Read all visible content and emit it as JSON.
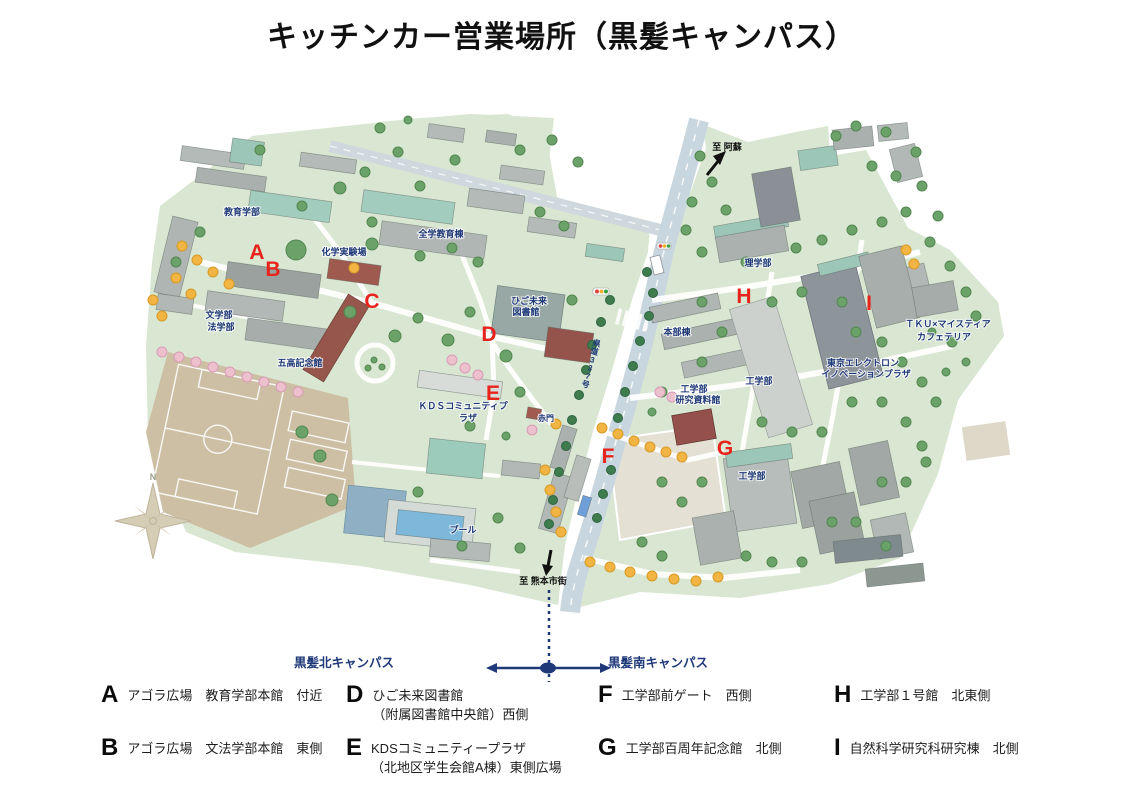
{
  "title": "キッチンカー営業場所（黒髪キャンパス）",
  "colors": {
    "marker_red": "#e8231c",
    "label_navy": "#1e3878",
    "campus_green": "#d9e7d2",
    "road_blue": "#c7d6df",
    "field_tan": "#cdbfa4"
  },
  "map": {
    "markers": [
      {
        "id": "A",
        "x": 257,
        "y": 259
      },
      {
        "id": "B",
        "x": 273,
        "y": 276
      },
      {
        "id": "C",
        "x": 372,
        "y": 308
      },
      {
        "id": "D",
        "x": 489,
        "y": 341
      },
      {
        "id": "E",
        "x": 493,
        "y": 400
      },
      {
        "id": "F",
        "x": 608,
        "y": 463
      },
      {
        "id": "G",
        "x": 725,
        "y": 455
      },
      {
        "id": "H",
        "x": 744,
        "y": 303
      },
      {
        "id": "I",
        "x": 869,
        "y": 310
      }
    ],
    "labels": [
      {
        "text": "教育学部",
        "x": 242,
        "y": 215
      },
      {
        "text": "化学実験場",
        "x": 344,
        "y": 255
      },
      {
        "text": "全学教育棟",
        "x": 441,
        "y": 237
      },
      {
        "text": "文学部",
        "x": 219,
        "y": 318
      },
      {
        "text": "法学部",
        "x": 221,
        "y": 330
      },
      {
        "text": "五高記念館",
        "x": 300,
        "y": 366
      },
      {
        "text": "ひご未来",
        "x": 529,
        "y": 304
      },
      {
        "text": "図書館",
        "x": 526,
        "y": 315
      },
      {
        "text": "ＫＤＳコミュニティプ",
        "x": 463,
        "y": 409
      },
      {
        "text": "ラザ",
        "x": 468,
        "y": 421
      },
      {
        "text": "赤門",
        "x": 546,
        "y": 421,
        "size": 8
      },
      {
        "text": "プール",
        "x": 463,
        "y": 533
      },
      {
        "text": "本部棟",
        "x": 677,
        "y": 335
      },
      {
        "text": "理学部",
        "x": 758,
        "y": 266
      },
      {
        "text": "工学部",
        "x": 694,
        "y": 392
      },
      {
        "text": "研究資料館",
        "x": 698,
        "y": 403
      },
      {
        "text": "工学部",
        "x": 759,
        "y": 384
      },
      {
        "text": "東京エレクトロン",
        "x": 863,
        "y": 366
      },
      {
        "text": "イノベーションプラザ",
        "x": 866,
        "y": 377
      },
      {
        "text": "ＴＫＵ×マイスティア",
        "x": 948,
        "y": 327
      },
      {
        "text": "カフェテリア",
        "x": 944,
        "y": 340
      },
      {
        "text": "工学部",
        "x": 752,
        "y": 479
      }
    ],
    "road_label": {
      "text": "県道337号",
      "x": 596,
      "y": 346,
      "rotate": 15
    },
    "direction_labels": [
      {
        "text": "至 阿蘇",
        "x": 727,
        "y": 150
      },
      {
        "text": "至 熊本市街",
        "x": 543,
        "y": 584
      }
    ],
    "compass_label": "N"
  },
  "campus_selector": {
    "north_label": "黒髪北キャンパス",
    "south_label": "黒髪南キャンパス"
  },
  "legend": {
    "items": [
      {
        "letter": "A",
        "lines": [
          "アゴラ広場　教育学部本館　付近"
        ]
      },
      {
        "letter": "B",
        "lines": [
          "アゴラ広場　文法学部本館　東側"
        ]
      },
      {
        "letter": "D",
        "lines": [
          "ひご未来図書館",
          "（附属図書館中央館）西側"
        ]
      },
      {
        "letter": "E",
        "lines": [
          "KDSコミュニティープラザ",
          "（北地区学生会館A棟）東側広場"
        ]
      },
      {
        "letter": "F",
        "lines": [
          "工学部前ゲート　西側"
        ]
      },
      {
        "letter": "G",
        "lines": [
          "工学部百周年記念館　北側"
        ]
      },
      {
        "letter": "H",
        "lines": [
          "工学部１号館　北東側"
        ]
      },
      {
        "letter": "I",
        "lines": [
          "自然科学研究科研究棟　北側"
        ]
      }
    ]
  }
}
